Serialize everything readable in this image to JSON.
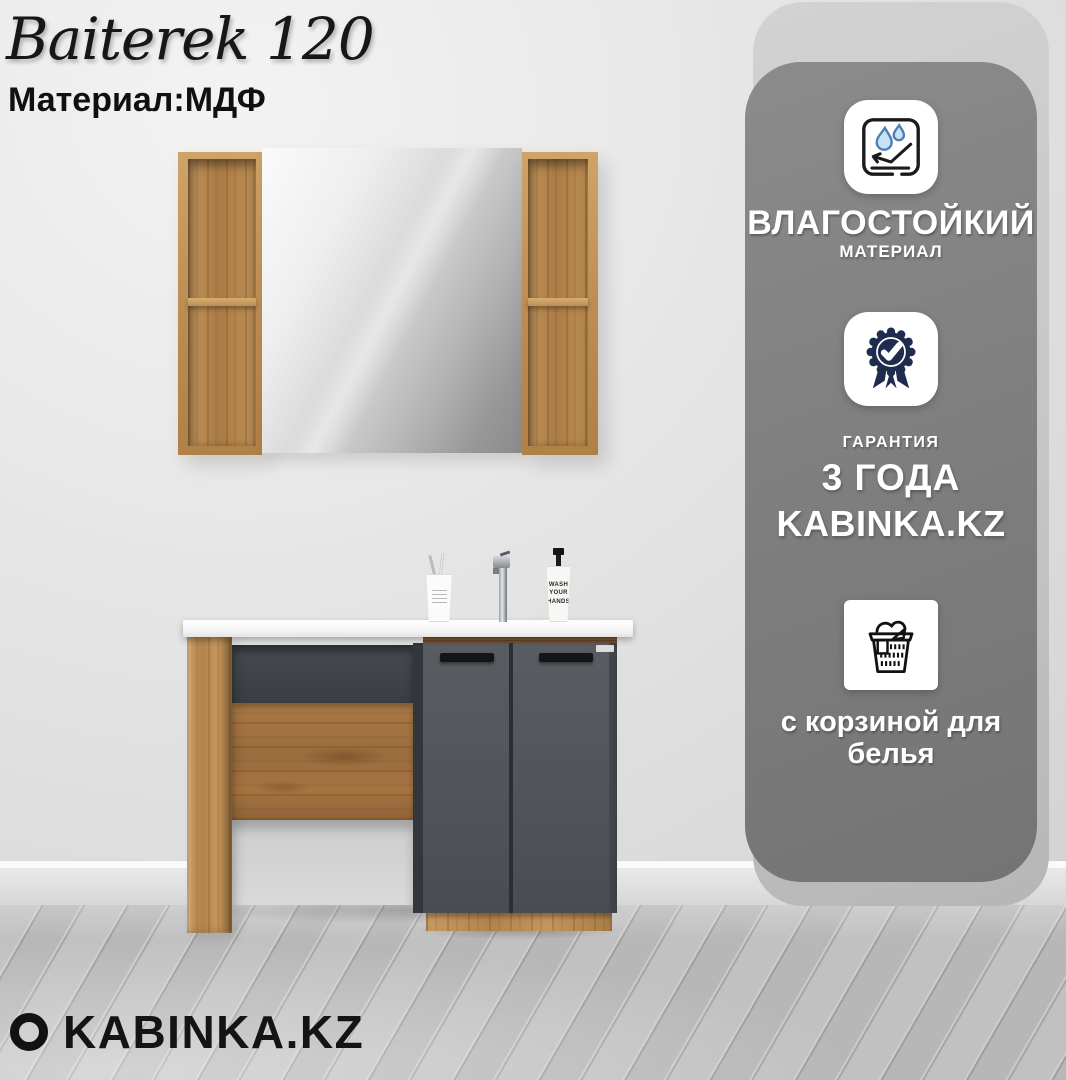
{
  "header": {
    "title": "Baiterek 120",
    "material": "Материал:МДФ"
  },
  "features_panel": {
    "items": [
      {
        "id": "moisture-resistant",
        "icon": "water-drops-icon",
        "title": "ВЛАГОСТОЙКИЙ",
        "subtitle": "МАТЕРИАЛ"
      },
      {
        "id": "warranty",
        "icon": "warranty-badge-icon",
        "label": "ГАРАНТИЯ",
        "value": "3 ГОДА",
        "brand": "KABINKA.KZ"
      },
      {
        "id": "laundry-basket",
        "icon": "laundry-basket-icon",
        "text": "с корзиной для белья"
      }
    ]
  },
  "scene": {
    "soap_text": [
      "WASH",
      "YOUR",
      "HANDS"
    ]
  },
  "footer": {
    "brand": "KABINKA.KZ"
  },
  "colors": {
    "panel_bg": "#7d7d7d",
    "card_bg": "#c6c6c6",
    "accent_navy": "#1e2c4e",
    "drop_blue": "#c7e2f6",
    "door_gray": "#51555a",
    "wood": "#bd8e54"
  }
}
